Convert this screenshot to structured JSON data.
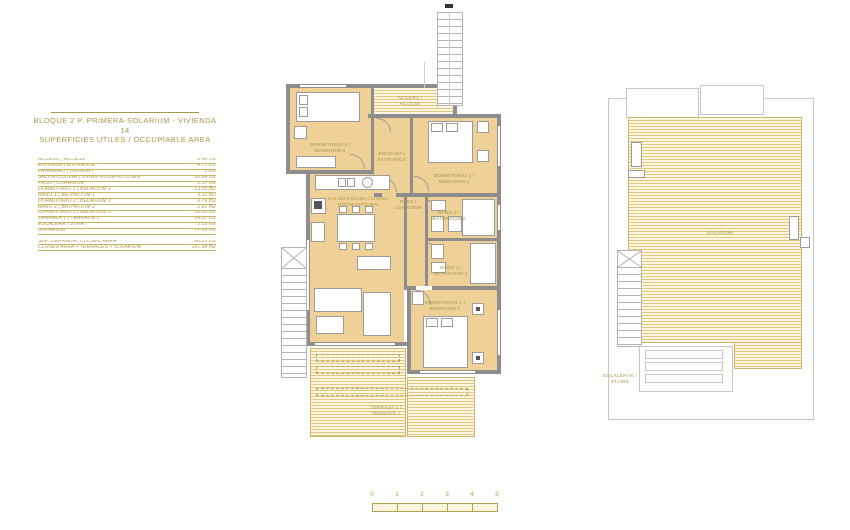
{
  "title": {
    "line1": "BLOQUE 2 P. PRIMERA-SOLARIUM - VIVIENDA 14",
    "line2": "SUPERFICIES ÚTILES / OCCUPIABLE AREA"
  },
  "areas_table": {
    "rows": [
      {
        "label": "ACCESO | ACCESS",
        "value": "3.46 m2"
      },
      {
        "label": "ENTRADA | ENTRANCE",
        "value": "4.71 m2"
      },
      {
        "label": "LAVADERO | LAUNDRY",
        "value": "0 m2"
      },
      {
        "label": "SALÓN-COCINA | LIVING ROOM-KITCHEN",
        "value": "30.54 m2"
      },
      {
        "label": "PASO | CORRIDOR",
        "value": "1.17 m2"
      },
      {
        "label": "DORMITORIO 1 | BEDROOM 1",
        "value": "13.05 m2"
      },
      {
        "label": "BAÑO 1 | BATHROOM 1",
        "value": "3.32 m2"
      },
      {
        "label": "DORMITORIO 2 | BEDROOM 2",
        "value": "9.79 m2"
      },
      {
        "label": "BAÑO 2 | BATHROOM 2",
        "value": "2.62 m2"
      },
      {
        "label": "DORMITORIO 3 | BEDROOM 3",
        "value": "10.06 m2"
      },
      {
        "label": "TERRAZA 1 | TERRACE 1",
        "value": "24.87 m2"
      },
      {
        "label": "ESCALERA / STAIR",
        "value": "5.29 m2"
      },
      {
        "label": "SOLARIUM",
        "value": "77.09 m2"
      }
    ],
    "summary_rows": [
      {
        "label": "SUP. CERRADA | CLOSED AREA",
        "value": "90.13 m2"
      },
      {
        "label": "CLOSED AREA + TERRACES + SOLARIUM",
        "value": "197.38 m2"
      }
    ]
  },
  "floor_plan": {
    "labels": {
      "acceso": "ACCESO / ACCESS",
      "dormitorio3": "DORMITORIO 3 / BEDROOM 3",
      "entrada": "ENTRADA / ENTRANCE",
      "dormitorio2": "DORMITORIO 2 / BEDROOM 2",
      "salon": "SALÓN-COCINA / LIVING ROOM-KITCHEN",
      "paso": "PASO / CORRIDOR",
      "bano2": "BAÑO 2 / BATHROOM 2",
      "bano1": "BAÑO 1 / BATHROOM 1",
      "dormitorio1": "DORMITORIO 1 / BEDROOM 1",
      "terraza1": "TERRAZA 1 / TERRACE 1"
    }
  },
  "solarium_plan": {
    "labels": {
      "solarium": "SOLARIUM",
      "escaleras": "ESCALERAS / STAIRS"
    }
  },
  "scale_bar": {
    "ticks": [
      "0",
      "1",
      "2",
      "3",
      "4",
      "5"
    ]
  },
  "colors": {
    "floor_fill": "#efd198",
    "wall": "#8d8d8d",
    "deck_stripe": "#e3c77d",
    "accent_text": "#a8984a",
    "scale": "#b3a050"
  }
}
